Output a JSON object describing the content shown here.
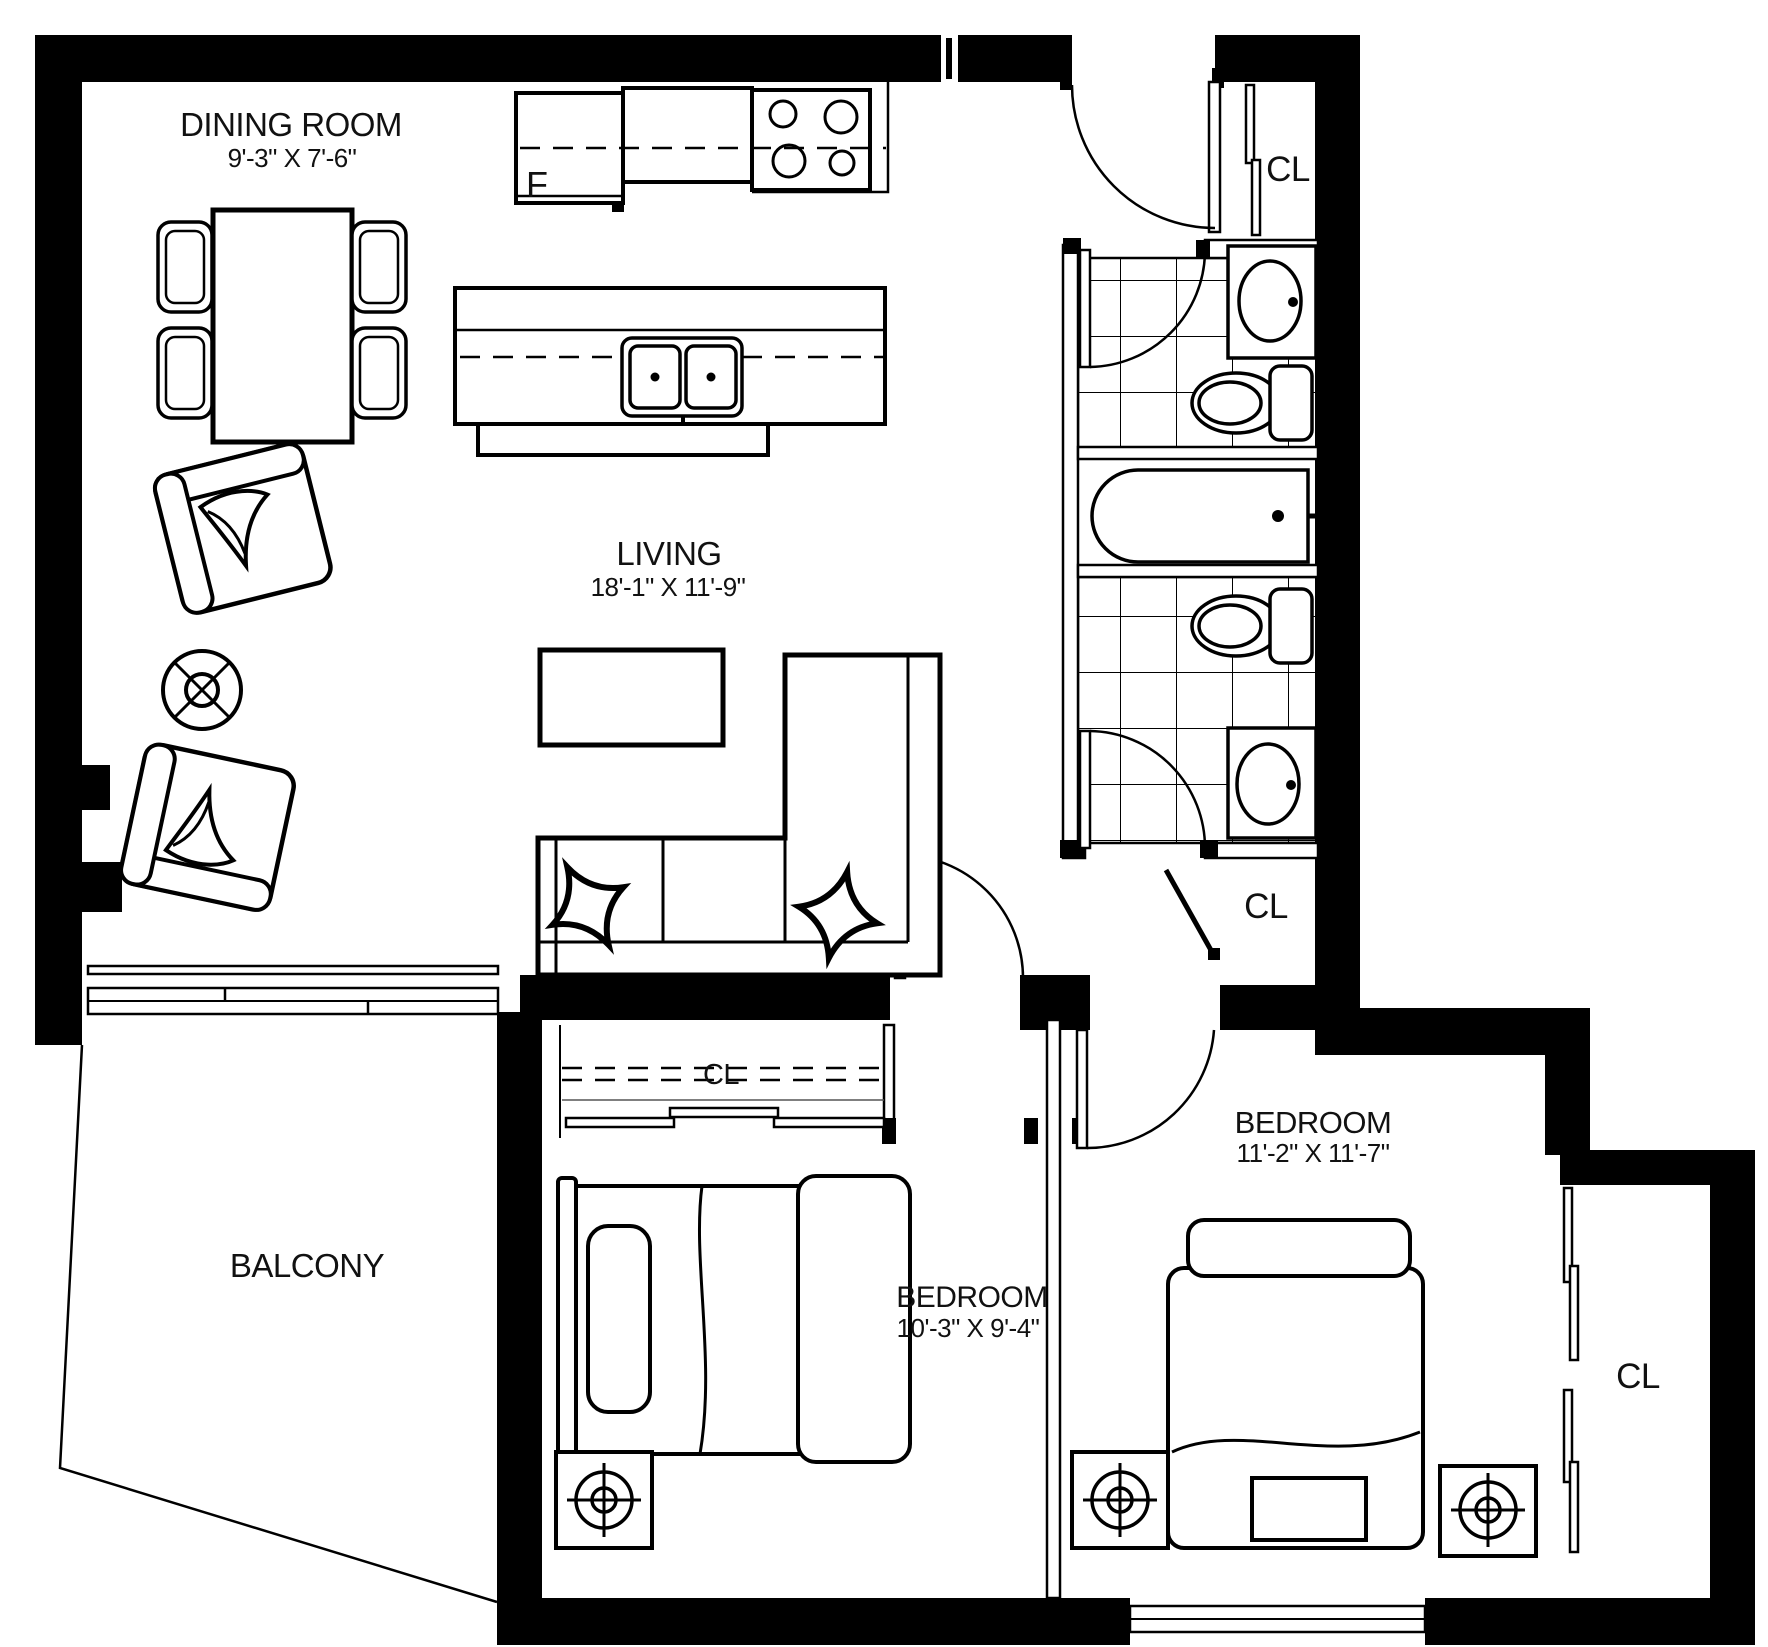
{
  "colors": {
    "line": "#000000",
    "background": "#ffffff"
  },
  "rooms": {
    "dining": {
      "name": "DINING ROOM",
      "dims": "9'-3\" X 7'-6\""
    },
    "living": {
      "name": "LIVING",
      "dims": "18'-1\" X 11'-9\""
    },
    "bedroom_center": {
      "name": "BEDROOM",
      "dims": "10'-3\" X 9'-4\""
    },
    "bedroom_right": {
      "name": "BEDROOM",
      "dims": "11'-2\" X 11'-7\""
    },
    "balcony": {
      "name": "BALCONY"
    }
  },
  "closets": {
    "entry": {
      "label": "CL"
    },
    "hall": {
      "label": "CL"
    },
    "bedroom_center": {
      "label": "CL"
    },
    "bedroom_right": {
      "label": "CL"
    }
  },
  "appliances": {
    "fridge": {
      "label": "F"
    }
  }
}
